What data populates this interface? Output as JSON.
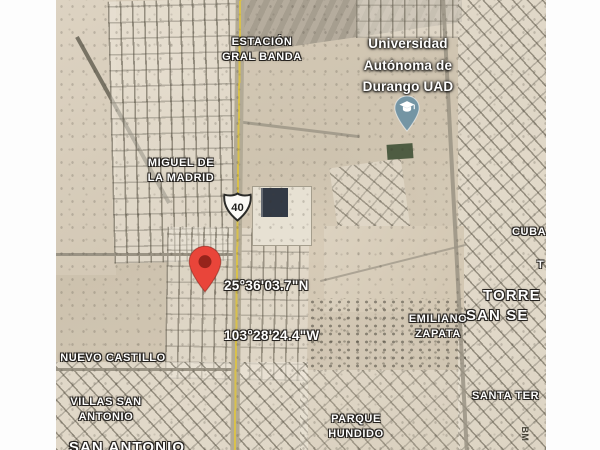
{
  "map": {
    "view_type": "satellite",
    "coordinates_label": {
      "line1": "25°36'03.7\"N",
      "line2": "103°28'24.4\"W"
    },
    "highway_shield": {
      "number": "40"
    },
    "place_labels": [
      {
        "id": "estacion-gral-banda",
        "text": "ESTACIÓN\nGRAL BANDA"
      },
      {
        "id": "miguel-de-la-madrid",
        "text": "MIGUEL DE\nLA MADRID"
      },
      {
        "id": "universidad-autonoma-durango",
        "text": "Universidad\nAutónoma de\nDurango UAD"
      },
      {
        "id": "nuevo-castillo",
        "text": "NUEVO CASTILLO"
      },
      {
        "id": "villas-san-antonio",
        "text": "VILLAS SAN\nANTONIO"
      },
      {
        "id": "san-antonio",
        "text": "SAN ANTONIO"
      },
      {
        "id": "emiliano-zapata",
        "text": "EMILIANO\nZAPATA"
      },
      {
        "id": "parque-hundido",
        "text": "PARQUE\nHUNDIDO"
      },
      {
        "id": "santa-teresa-partial",
        "text": "SANTA TER"
      },
      {
        "id": "cuba-partial",
        "text": "CUBA"
      },
      {
        "id": "t-partial",
        "text": "T"
      },
      {
        "id": "torreon-partial",
        "text": "TORRE"
      },
      {
        "id": "san-se-partial",
        "text": "SAN SE"
      },
      {
        "id": "road-name-partial",
        "text": "BM"
      }
    ],
    "markers": [
      {
        "id": "red-location-pin",
        "color": "#E9453A"
      },
      {
        "id": "university-education-pin",
        "color": "#7495A4",
        "icon": "graduation-cap"
      }
    ],
    "colors": {
      "terrain": "#cfc4b0",
      "street": "#9a9384",
      "highway_stripe": "#d9c14b",
      "sports_field_green": "#4e5c42",
      "dark_building": "#333a45",
      "letterbox_bar": "#fdfdfd"
    }
  }
}
